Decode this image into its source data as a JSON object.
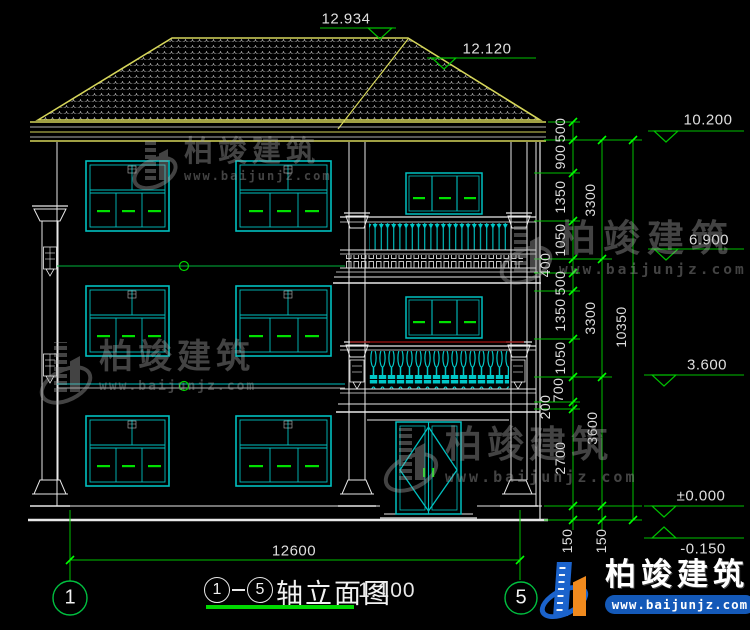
{
  "drawing": {
    "title": {
      "axis_left": "1",
      "axis_right": "5",
      "name": "轴立面图",
      "scale": "1:100"
    },
    "axes": {
      "left": "1",
      "right": "5"
    },
    "roof_dims": {
      "ridge": "12.934",
      "secondary": "12.120"
    },
    "levels": {
      "eave": "10.200",
      "third": "6.900",
      "second": "3.600",
      "zero": "±0.000",
      "ground": "-0.150"
    },
    "chains": {
      "inner": [
        "500",
        "900",
        "1350",
        "1050",
        "400",
        "500",
        "1350",
        "1050",
        "700",
        "200",
        "2700",
        "150"
      ],
      "storey": [
        "3300",
        "3300",
        "3600",
        "150"
      ],
      "total": "10350",
      "width": "12600"
    }
  },
  "watermark": {
    "company": "柏竣建筑",
    "website": "www.baijunjz.com"
  },
  "brand": {
    "company": "柏竣建筑",
    "website": "www.baijunjz.com"
  }
}
